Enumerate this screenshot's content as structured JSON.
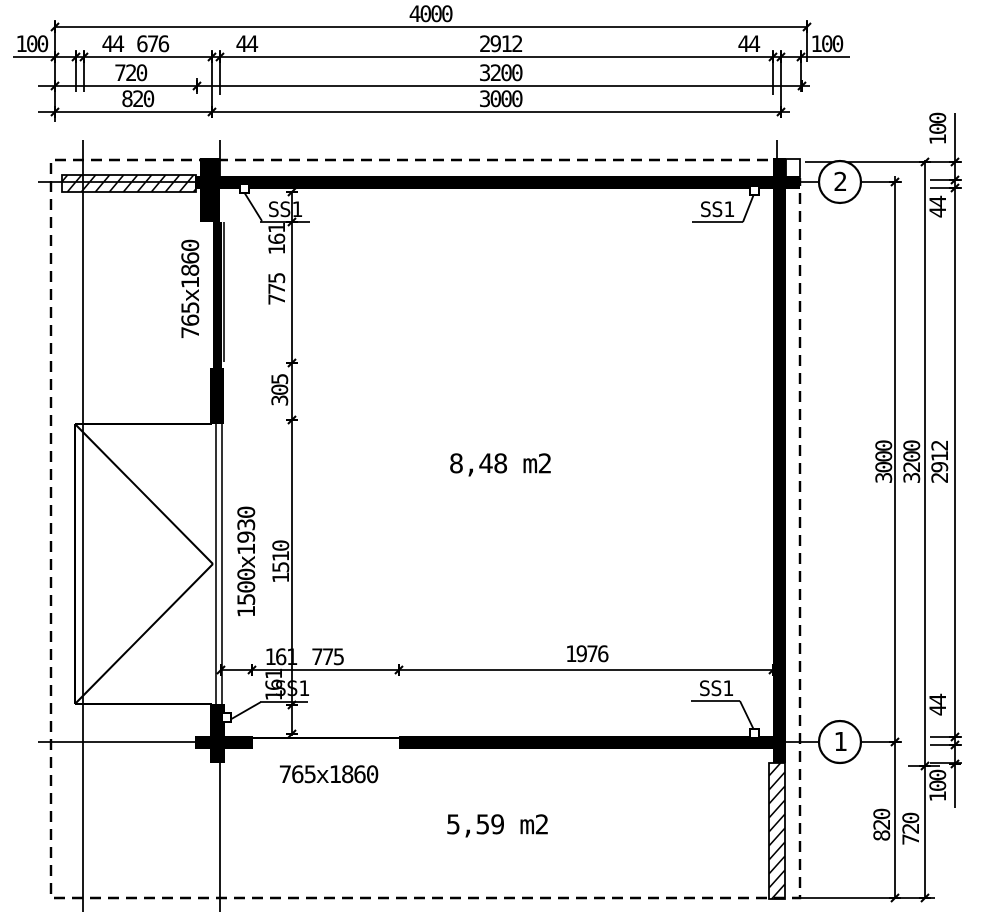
{
  "colors": {
    "ink": "#000000",
    "paper": "#ffffff"
  },
  "dims": {
    "overall_width": "4000",
    "top_chain": [
      "100",
      "44",
      "676",
      "44",
      "2912",
      "44",
      "100"
    ],
    "top_row_720_3200": [
      "720",
      "3200"
    ],
    "top_row_820_3000": [
      "820",
      "3000"
    ],
    "right_chain": [
      "100",
      "44",
      "2912",
      "44",
      "100"
    ],
    "right_row_3200_720": [
      "3200",
      "720"
    ],
    "right_row_3000_820": [
      "3000",
      "820"
    ],
    "interior_vertical": [
      "161",
      "775",
      "305",
      "1510",
      "161"
    ],
    "interior_horizontal": [
      "161",
      "775",
      "1976"
    ]
  },
  "labels": {
    "main_room_area": "8,48 m2",
    "terrace_area": "5,59 m2",
    "single_door_size": "765x1860",
    "double_door_size": "1500x1930",
    "wall_connector": "SS1"
  },
  "axes": {
    "axis_1": "1",
    "axis_2": "2"
  }
}
